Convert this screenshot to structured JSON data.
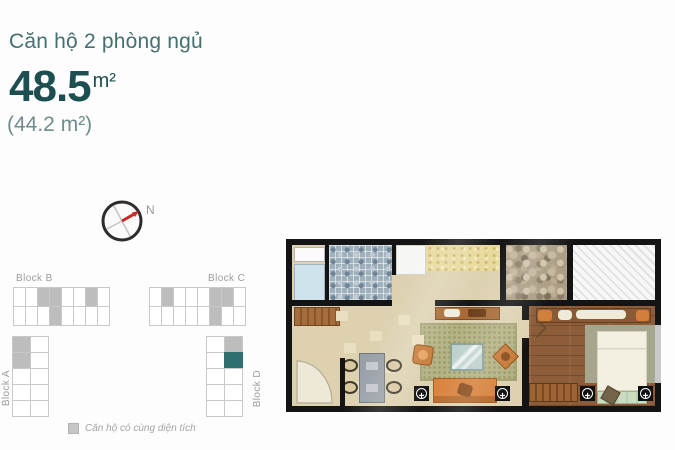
{
  "header": {
    "title": "Căn hộ 2 phòng ngủ",
    "area_main_value": "48.5",
    "area_main_unit": "m²",
    "area_secondary": "(44.2 m²)"
  },
  "compass": {
    "north_label": "N"
  },
  "blocks": {
    "block_b": {
      "label": "Block B",
      "cells": [
        [
          0,
          0,
          1,
          1,
          0,
          0,
          1,
          0
        ],
        [
          0,
          0,
          0,
          1,
          0,
          0,
          0,
          0
        ]
      ]
    },
    "block_c": {
      "label": "Block C",
      "cells": [
        [
          0,
          1,
          0,
          0,
          0,
          1,
          1,
          0
        ],
        [
          0,
          0,
          0,
          0,
          0,
          1,
          0,
          0
        ]
      ]
    },
    "block_a": {
      "label": "Block A",
      "cells": [
        [
          1,
          0
        ],
        [
          1,
          0
        ],
        [
          0,
          0
        ],
        [
          0,
          0
        ],
        [
          0,
          0
        ]
      ]
    },
    "block_d": {
      "label": "Block D",
      "cells": [
        [
          0,
          1
        ],
        [
          0,
          2
        ],
        [
          0,
          0
        ],
        [
          0,
          0
        ],
        [
          0,
          0
        ]
      ]
    }
  },
  "legend": {
    "text": "Căn hộ có cùng diện tích",
    "swatch_color": "#c6c6c6"
  },
  "floorplan": {
    "ac_symbol": "+"
  },
  "colors": {
    "title_teal": "#44706f",
    "accent_teal": "#1d4e50",
    "secondary_teal": "#6f8b8b",
    "highlight_gray": "#bdbdbd",
    "unit_highlight_teal": "#2f6f6f",
    "wall": "#141414",
    "floor": "#ddd1b0",
    "compass_needle_red": "#cc2a22"
  }
}
